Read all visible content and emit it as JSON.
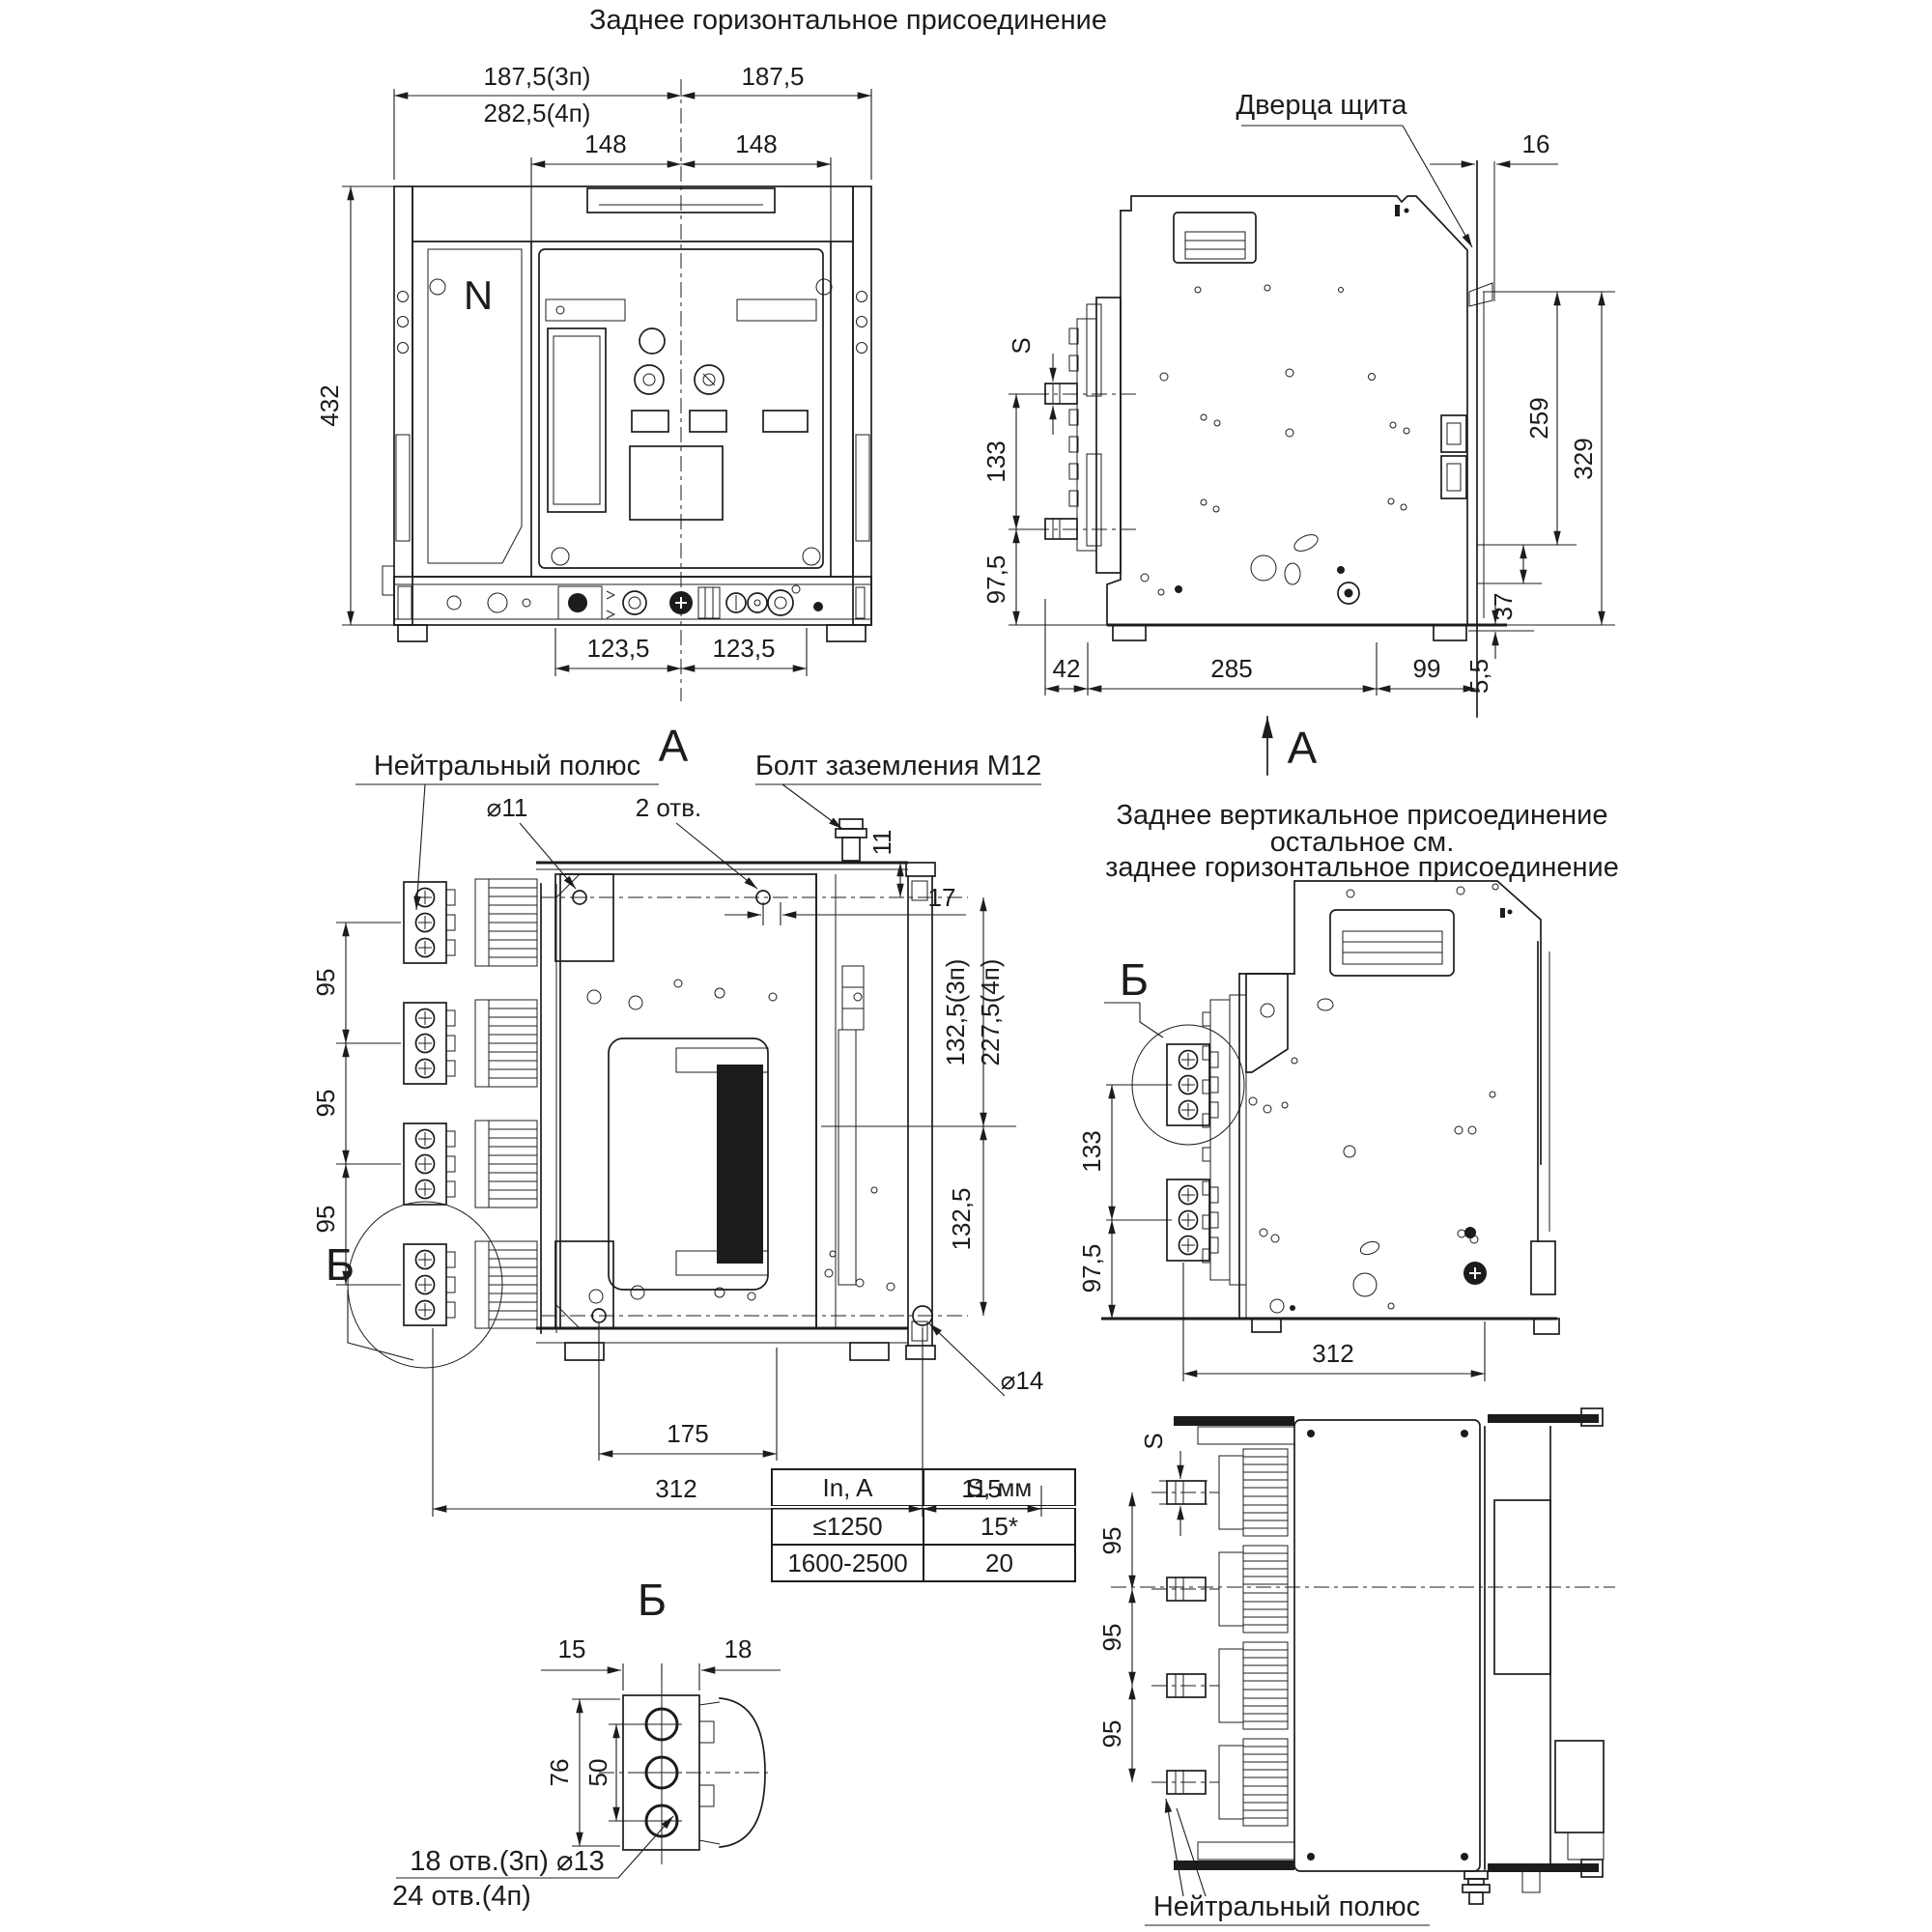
{
  "title": "Заднее горизонтальное присоединение",
  "front_view": {
    "w3p": "187,5(3п)",
    "w4p": "282,5(4п)",
    "w_right": "187,5",
    "pole_l": "148",
    "pole_r": "148",
    "height": "432",
    "bot_l": "123,5",
    "bot_r": "123,5",
    "neutral": "N",
    "label": "А"
  },
  "side_view": {
    "door": "Дверца щита",
    "gap": "16",
    "s": "S",
    "d133": "133",
    "d97": "97,5",
    "d42": "42",
    "d285": "285",
    "d99": "99",
    "d259": "259",
    "d329": "329",
    "d37": "37",
    "d55": "5,5",
    "label": "А"
  },
  "rear_view": {
    "neutral_pole": "Нейтральный полюс",
    "ground_bolt": "Болт заземления М12",
    "dia11": "⌀11",
    "holes2": "2 отв.",
    "d11": "11",
    "d17": "17",
    "v3p": "132,5(3п)",
    "v4p": "227,5(4п)",
    "v2": "132,5",
    "p95_1": "95",
    "p95_2": "95",
    "p95_3": "95",
    "detail": "Б",
    "d175": "175",
    "d312": "312",
    "d115": "115",
    "dia14": "⌀14"
  },
  "vert_view": {
    "title1": "Заднее вертикальное присоединение",
    "title2": "остальное см.",
    "title3": "заднее горизонтальное присоединение",
    "detail": "Б",
    "d133": "133",
    "d97": "97,5",
    "d312": "312"
  },
  "top_view": {
    "s": "S",
    "p95_1": "95",
    "p95_2": "95",
    "p95_3": "95",
    "neutral_pole": "Нейтральный полюс"
  },
  "detail_b": {
    "label": "Б",
    "d15": "15",
    "d18": "18",
    "d76": "76",
    "d50": "50",
    "holes3p": "18 отв.(3п) ⌀13",
    "holes4p": "24 отв.(4п)"
  },
  "table": {
    "headers": [
      "In, A",
      "S, мм"
    ],
    "rows": [
      [
        "≤1250",
        "15*"
      ],
      [
        "1600-2500",
        "20"
      ]
    ]
  }
}
